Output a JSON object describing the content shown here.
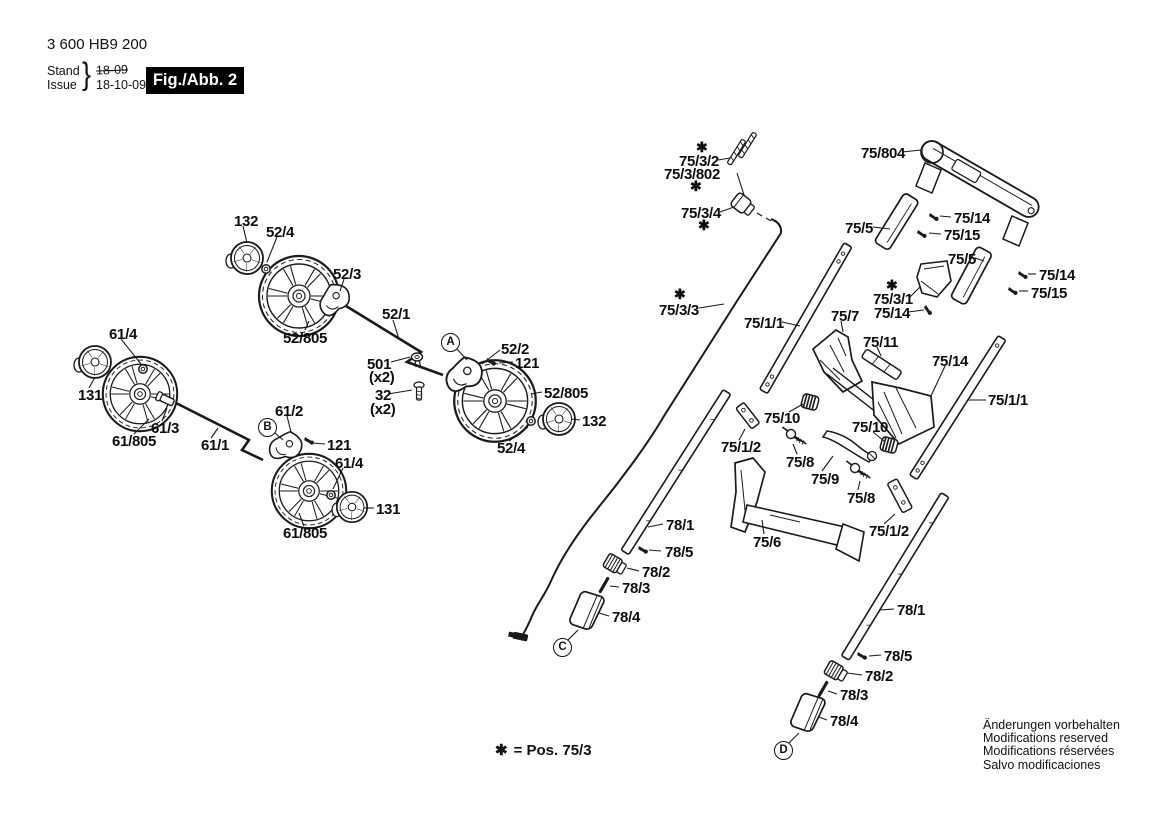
{
  "header": {
    "part_number": "3 600 HB9 200",
    "stand_label": "Stand",
    "issue_label": "Issue",
    "brace": "}",
    "stand_value": "18-09",
    "issue_value": "18-10-09",
    "figure_badge": "Fig./Abb. 2"
  },
  "legend": {
    "symbol": "✱",
    "text": "= Pos. 75/3"
  },
  "footer": {
    "lines": [
      "Änderungen vorbehalten",
      "Modifications reserved",
      "Modifications réservées",
      "Salvo modificaciones"
    ]
  },
  "colors": {
    "ink": "#1a1a1a",
    "background": "#ffffff",
    "badge_bg": "#000000",
    "badge_text": "#ffffff"
  },
  "callouts": [
    {
      "letter": "A",
      "x": 450,
      "y": 342
    },
    {
      "letter": "B",
      "x": 267,
      "y": 427
    },
    {
      "letter": "C",
      "x": 562,
      "y": 647
    },
    {
      "letter": "D",
      "x": 783,
      "y": 750
    }
  ],
  "labels": [
    {
      "text": "132",
      "x": 234,
      "y": 215
    },
    {
      "text": "52/4",
      "x": 266,
      "y": 226
    },
    {
      "text": "52/3",
      "x": 333,
      "y": 268
    },
    {
      "text": "52/805",
      "x": 283,
      "y": 332
    },
    {
      "text": "52/1",
      "x": 382,
      "y": 308
    },
    {
      "text": "61/4",
      "x": 109,
      "y": 328
    },
    {
      "text": "131",
      "x": 78,
      "y": 389
    },
    {
      "text": "61/805",
      "x": 112,
      "y": 435
    },
    {
      "text": "61/3",
      "x": 151,
      "y": 422
    },
    {
      "text": "61/1",
      "x": 201,
      "y": 439
    },
    {
      "text": "61/2",
      "x": 275,
      "y": 405
    },
    {
      "text": "121",
      "x": 327,
      "y": 439
    },
    {
      "text": "61/4",
      "x": 335,
      "y": 457
    },
    {
      "text": "131",
      "x": 376,
      "y": 503
    },
    {
      "text": "61/805",
      "x": 283,
      "y": 527
    },
    {
      "text": "501",
      "x": 367,
      "y": 358
    },
    {
      "text": "(x2)",
      "x": 369,
      "y": 371
    },
    {
      "text": "32",
      "x": 375,
      "y": 389
    },
    {
      "text": "(x2)",
      "x": 370,
      "y": 403
    },
    {
      "text": "52/2",
      "x": 501,
      "y": 343
    },
    {
      "text": "121",
      "x": 515,
      "y": 357
    },
    {
      "text": "52/805",
      "x": 544,
      "y": 387
    },
    {
      "text": "132",
      "x": 582,
      "y": 415
    },
    {
      "text": "52/4",
      "x": 497,
      "y": 442
    },
    {
      "text": "✱",
      "x": 696,
      "y": 142,
      "s": 1
    },
    {
      "text": "75/3/2",
      "x": 679,
      "y": 155
    },
    {
      "text": "75/3/802",
      "x": 664,
      "y": 168
    },
    {
      "text": "✱",
      "x": 690,
      "y": 181,
      "s": 1
    },
    {
      "text": "75/3/4",
      "x": 681,
      "y": 207
    },
    {
      "text": "✱",
      "x": 698,
      "y": 220,
      "s": 1
    },
    {
      "text": "✱",
      "x": 674,
      "y": 289,
      "s": 1
    },
    {
      "text": "75/3/3",
      "x": 659,
      "y": 304
    },
    {
      "text": "75/804",
      "x": 861,
      "y": 147
    },
    {
      "text": "75/5",
      "x": 845,
      "y": 222
    },
    {
      "text": "75/14",
      "x": 954,
      "y": 212
    },
    {
      "text": "75/15",
      "x": 944,
      "y": 229
    },
    {
      "text": "75/5",
      "x": 948,
      "y": 253
    },
    {
      "text": "75/14",
      "x": 1039,
      "y": 269
    },
    {
      "text": "75/15",
      "x": 1031,
      "y": 287
    },
    {
      "text": "✱",
      "x": 886,
      "y": 280,
      "s": 1
    },
    {
      "text": "75/3/1",
      "x": 873,
      "y": 293
    },
    {
      "text": "75/14",
      "x": 874,
      "y": 307
    },
    {
      "text": "75/1/1",
      "x": 744,
      "y": 317
    },
    {
      "text": "75/7",
      "x": 831,
      "y": 310
    },
    {
      "text": "75/11",
      "x": 863,
      "y": 336
    },
    {
      "text": "75/14",
      "x": 932,
      "y": 355
    },
    {
      "text": "75/1/1",
      "x": 988,
      "y": 394
    },
    {
      "text": "75/10",
      "x": 764,
      "y": 412
    },
    {
      "text": "75/10",
      "x": 852,
      "y": 421
    },
    {
      "text": "75/1/2",
      "x": 721,
      "y": 441
    },
    {
      "text": "75/8",
      "x": 786,
      "y": 456
    },
    {
      "text": "75/9",
      "x": 811,
      "y": 473
    },
    {
      "text": "75/8",
      "x": 847,
      "y": 492
    },
    {
      "text": "75/6",
      "x": 753,
      "y": 536
    },
    {
      "text": "75/1/2",
      "x": 869,
      "y": 525
    },
    {
      "text": "78/1",
      "x": 666,
      "y": 519
    },
    {
      "text": "78/5",
      "x": 665,
      "y": 546
    },
    {
      "text": "78/2",
      "x": 642,
      "y": 566
    },
    {
      "text": "78/3",
      "x": 622,
      "y": 582
    },
    {
      "text": "78/4",
      "x": 612,
      "y": 611
    },
    {
      "text": "78/1",
      "x": 897,
      "y": 604
    },
    {
      "text": "78/5",
      "x": 884,
      "y": 650
    },
    {
      "text": "78/2",
      "x": 865,
      "y": 670
    },
    {
      "text": "78/3",
      "x": 840,
      "y": 689
    },
    {
      "text": "78/4",
      "x": 830,
      "y": 715
    }
  ]
}
